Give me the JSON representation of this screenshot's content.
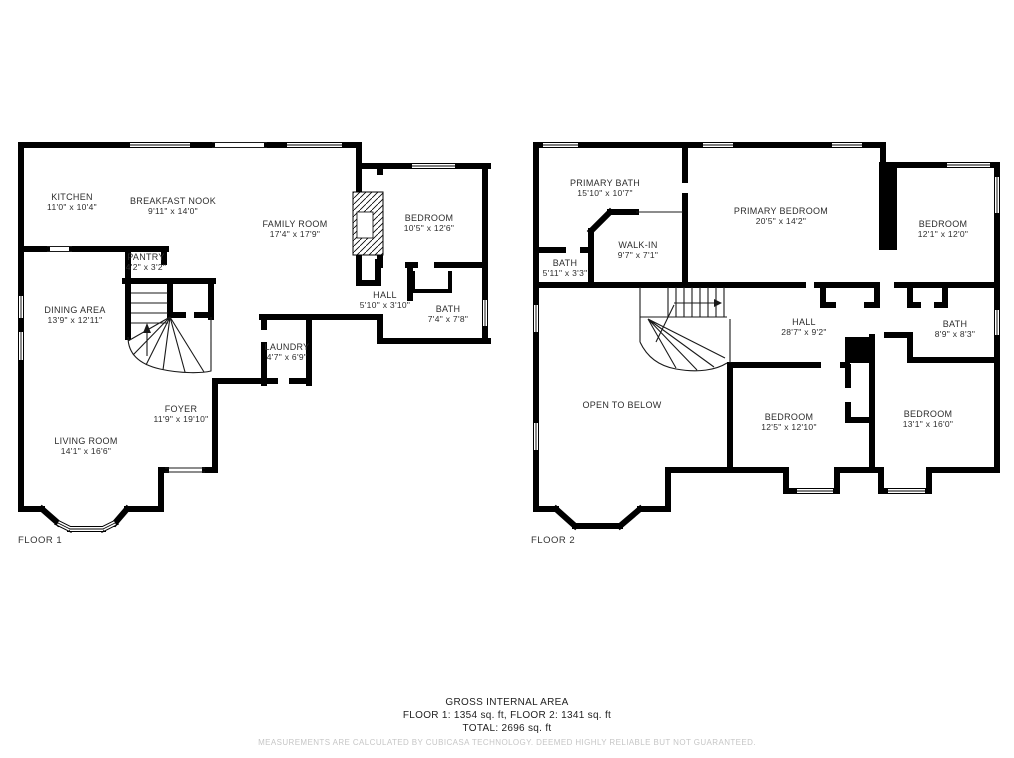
{
  "colors": {
    "wall": "#000000",
    "label_text": "#2d2d2d",
    "footer_text": "#1f1f1f",
    "disclaimer_text": "#c6c6c6",
    "background": "#ffffff"
  },
  "floor1": {
    "label": "FLOOR 1",
    "rooms": [
      {
        "name": "KITCHEN",
        "dims": "11'0\" x 10'4\""
      },
      {
        "name": "BREAKFAST NOOK",
        "dims": "9'11\" x 14'0\""
      },
      {
        "name": "FAMILY ROOM",
        "dims": "17'4\" x 17'9\""
      },
      {
        "name": "BEDROOM",
        "dims": "10'5\" x 12'6\""
      },
      {
        "name": "PANTRY",
        "dims": "4'2\" x 3'2\""
      },
      {
        "name": "DINING AREA",
        "dims": "13'9\" x 12'11\""
      },
      {
        "name": "HALL",
        "dims": "5'10\" x 3'10\""
      },
      {
        "name": "BATH",
        "dims": "7'4\" x 7'8\""
      },
      {
        "name": "LAUNDRY",
        "dims": "4'7\" x 6'9\""
      },
      {
        "name": "FOYER",
        "dims": "11'9\" x 19'10\""
      },
      {
        "name": "LIVING ROOM",
        "dims": "14'1\" x 16'6\""
      }
    ]
  },
  "floor2": {
    "label": "FLOOR 2",
    "rooms": [
      {
        "name": "PRIMARY BATH",
        "dims": "15'10\" x 10'7\""
      },
      {
        "name": "WALK-IN",
        "dims": "9'7\" x 7'1\""
      },
      {
        "name": "BATH",
        "dims": "5'11\" x 3'3\""
      },
      {
        "name": "PRIMARY BEDROOM",
        "dims": "20'5\" x 14'2\""
      },
      {
        "name": "BEDROOM",
        "dims": "12'1\" x 12'0\""
      },
      {
        "name": "HALL",
        "dims": "28'7\" x 9'2\""
      },
      {
        "name": "BATH",
        "dims": "8'9\" x 8'3\""
      },
      {
        "name": "OPEN TO BELOW",
        "dims": ""
      },
      {
        "name": "BEDROOM",
        "dims": "12'5\" x 12'10\""
      },
      {
        "name": "BEDROOM",
        "dims": "13'1\" x 16'0\""
      }
    ]
  },
  "footer": {
    "title": "GROSS INTERNAL AREA",
    "areas": "FLOOR 1: 1354 sq. ft, FLOOR 2: 1341 sq. ft",
    "total": "TOTAL: 2696 sq. ft",
    "disclaimer": "MEASUREMENTS ARE CALCULATED BY CUBICASA TECHNOLOGY. DEEMED HIGHLY RELIABLE BUT NOT GUARANTEED."
  }
}
